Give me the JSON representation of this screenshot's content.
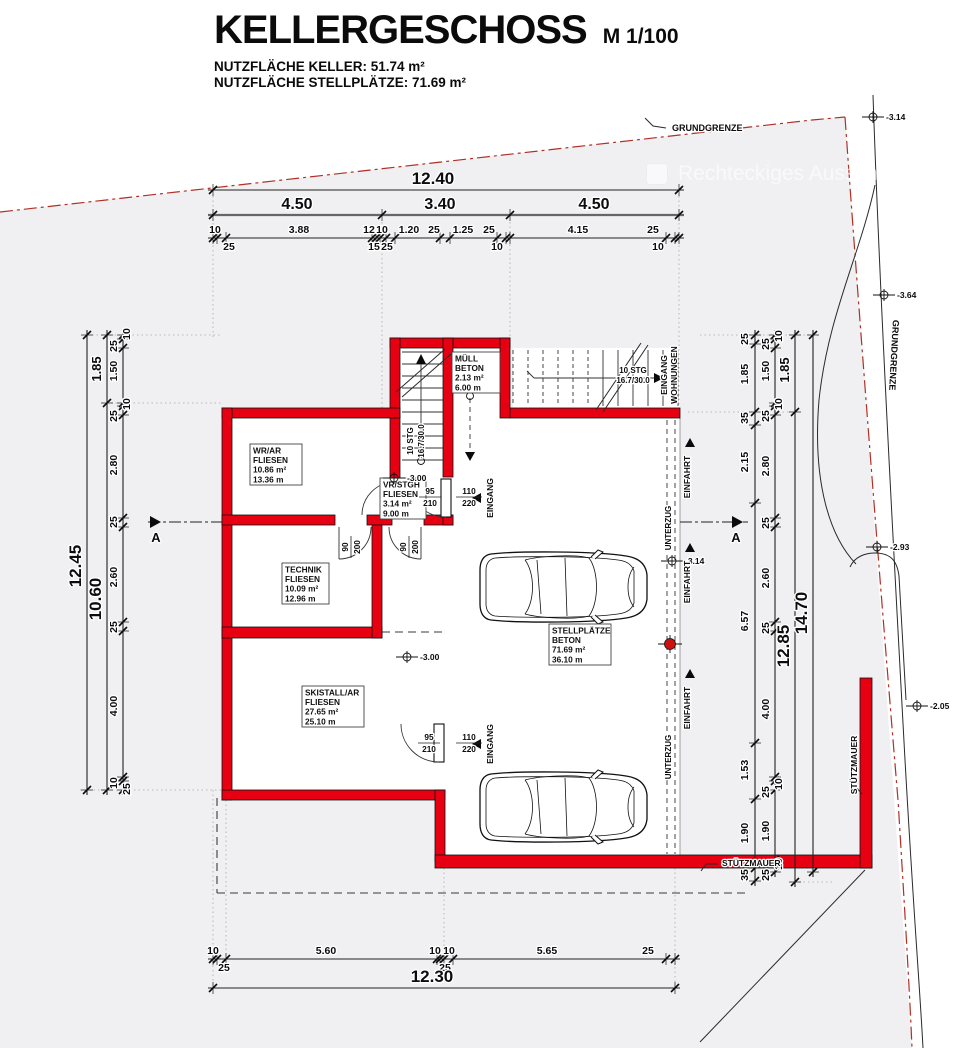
{
  "title": {
    "main": "KELLERGESCHOSS",
    "scale": "M 1/100",
    "sub1": "NUTZFLÄCHE KELLER: 51.74 m²",
    "sub2": "NUTZFLÄCHE STELLPLÄTZE: 71.69 m²"
  },
  "watermark": {
    "text": "Rechteckiges Ausschneiden"
  },
  "colors": {
    "wall": "#e60012",
    "boundary": "#b03026",
    "ground": "#f0f0f2"
  },
  "rooms": [
    {
      "name": "room-wr-ar",
      "x": 250,
      "y": 444,
      "w": 52,
      "h": 41,
      "lines": [
        "WR/AR",
        "FLIESEN",
        "10.86 m²",
        "13.36 m"
      ]
    },
    {
      "name": "room-muell",
      "x": 452,
      "y": 352,
      "w": 48,
      "h": 41,
      "lines": [
        "MÜLL",
        "BETON",
        "2.13 m²",
        "6.00 m"
      ]
    },
    {
      "name": "room-vr-stgh",
      "x": 380,
      "y": 478,
      "w": 46,
      "h": 41,
      "lines": [
        "VR/STGH",
        "FLIESEN",
        "3.14 m²",
        "9.00 m"
      ]
    },
    {
      "name": "room-technik",
      "x": 282,
      "y": 563,
      "w": 47,
      "h": 41,
      "lines": [
        "TECHNIK",
        "FLIESEN",
        "10.09 m²",
        "12.96 m"
      ]
    },
    {
      "name": "room-skistall",
      "x": 302,
      "y": 686,
      "w": 62,
      "h": 41,
      "lines": [
        "SKISTALL/AR",
        "FLIESEN",
        "27.65 m²",
        "25.10 m"
      ]
    },
    {
      "name": "room-stellplaetze",
      "x": 549,
      "y": 624,
      "w": 62,
      "h": 41,
      "lines": [
        "STELLPLÄTZE",
        "BETON",
        "71.69 m²",
        "36.10 m"
      ]
    }
  ],
  "door_labels": [
    {
      "name": "door-size-vr",
      "x": 430,
      "y": 497,
      "top": "95",
      "bottom": "210"
    },
    {
      "name": "door-size-entry-top",
      "x": 469,
      "y": 497,
      "top": "110",
      "bottom": "220"
    },
    {
      "name": "door-size-ski",
      "x": 429,
      "y": 743,
      "top": "95",
      "bottom": "210"
    },
    {
      "name": "door-size-entry-bot",
      "x": 469,
      "y": 743,
      "top": "110",
      "bottom": "220"
    },
    {
      "name": "door-size-technik",
      "x": 351,
      "y": 547,
      "top": "90",
      "bottom": "200",
      "r": -90
    },
    {
      "name": "door-size-corridor",
      "x": 409,
      "y": 547,
      "top": "90",
      "bottom": "200",
      "r": -90
    }
  ],
  "elevations": [
    {
      "x": 394,
      "y": 478,
      "label": "-3.00"
    },
    {
      "x": 407,
      "y": 657,
      "label": "-3.00"
    },
    {
      "x": 672,
      "y": 561,
      "label": "-3.14"
    },
    {
      "x": 873,
      "y": 117,
      "label": "-3.14"
    },
    {
      "x": 884,
      "y": 295,
      "label": "-3.64"
    },
    {
      "x": 877,
      "y": 547,
      "label": "-2.93"
    },
    {
      "x": 917,
      "y": 706,
      "label": "-2.05"
    }
  ],
  "column_marker": {
    "x": 670,
    "y": 644
  },
  "texts": [
    {
      "name": "grundgrenze-top",
      "t": "GRUNDGRENZE",
      "x": 672,
      "y": 131,
      "s": 9,
      "a": "start"
    },
    {
      "name": "grundgrenze-right",
      "t": "GRUNDGRENZE",
      "x": 891,
      "y": 355,
      "s": 9,
      "r": 93
    },
    {
      "name": "eingang-wohnungen-1",
      "t": "EINGANG",
      "x": 667,
      "y": 375,
      "s": 8.5,
      "r": -90
    },
    {
      "name": "eingang-wohnungen-2",
      "t": "WOHNUNGEN",
      "x": 677,
      "y": 375,
      "s": 8.5,
      "r": -90
    },
    {
      "name": "einfahrt-label-1",
      "t": "EINFAHRT",
      "x": 690,
      "y": 477,
      "s": 8.5,
      "r": -90
    },
    {
      "name": "einfahrt-label-2",
      "t": "EINFAHRT",
      "x": 690,
      "y": 582,
      "s": 8.5,
      "r": -90
    },
    {
      "name": "einfahrt-label-3",
      "t": "EINFAHRT",
      "x": 690,
      "y": 708,
      "s": 8.5,
      "r": -90
    },
    {
      "name": "unterzug-label-1",
      "t": "UNTERZUG",
      "x": 671,
      "y": 528,
      "s": 8,
      "r": -90
    },
    {
      "name": "unterzug-label-2",
      "t": "UNTERZUG",
      "x": 671,
      "y": 757,
      "s": 8,
      "r": -90
    },
    {
      "name": "stuetzmauer-bottom",
      "t": "STÜTZMAUER",
      "x": 722,
      "y": 866,
      "s": 8.5,
      "a": "start"
    },
    {
      "name": "stuetzmauer-right",
      "t": "STÜTZMAUER",
      "x": 857,
      "y": 765,
      "s": 8.5,
      "r": -90
    },
    {
      "name": "section-a-left",
      "t": "A",
      "x": 156,
      "y": 542,
      "s": 13,
      "b": 1
    },
    {
      "name": "section-a-right",
      "t": "A",
      "x": 736,
      "y": 542,
      "s": 13,
      "b": 1
    },
    {
      "name": "stair-int-label-1",
      "t": "10 STG",
      "x": 413,
      "y": 441,
      "s": 8,
      "r": -90
    },
    {
      "name": "stair-int-label-2",
      "t": "16.7/30.0",
      "x": 424,
      "y": 441,
      "s": 8,
      "r": -90
    },
    {
      "name": "stair-ext-label-1",
      "t": "10 STG",
      "x": 633,
      "y": 373,
      "s": 8
    },
    {
      "name": "stair-ext-label-2",
      "t": "16.7/30.0",
      "x": 633,
      "y": 383,
      "s": 8
    },
    {
      "name": "eingang-door-1",
      "t": "EINGANG",
      "x": 493,
      "y": 498,
      "s": 8.5,
      "r": -90
    },
    {
      "name": "eingang-door-2",
      "t": "EINGANG",
      "x": 493,
      "y": 744,
      "s": 8.5,
      "r": -90
    }
  ],
  "dims": {
    "h": [
      {
        "name": "top-total",
        "y": 190,
        "ticks": [
          213,
          679
        ],
        "labels": [
          {
            "t": "12.40",
            "x": 433,
            "dy": -6,
            "s": 17,
            "b": 1
          }
        ]
      },
      {
        "name": "top-mid",
        "y": 215,
        "thick": 1,
        "ticks": [
          213,
          382,
          510,
          679
        ],
        "labels": [
          {
            "t": "4.50",
            "x": 297,
            "dy": -6,
            "s": 16,
            "b": 1
          },
          {
            "t": "3.40",
            "x": 440,
            "dy": -6,
            "s": 16,
            "b": 1
          },
          {
            "t": "4.50",
            "x": 594,
            "dy": -6,
            "s": 16,
            "b": 1
          }
        ]
      },
      {
        "name": "top-detail",
        "y": 238,
        "ticks": [
          213,
          217,
          226,
          372,
          376,
          380,
          386,
          395,
          440,
          450,
          497,
          506,
          510,
          666,
          675,
          679
        ],
        "labels": [
          {
            "t": "10",
            "x": 215,
            "dy": -5
          },
          {
            "t": "3.88",
            "x": 299,
            "dy": -5
          },
          {
            "t": "12",
            "x": 369,
            "dy": -5
          },
          {
            "t": "10",
            "x": 382,
            "dy": -5
          },
          {
            "t": "1.20",
            "x": 409,
            "dy": -5
          },
          {
            "t": "25",
            "x": 434,
            "dy": -5
          },
          {
            "t": "1.25",
            "x": 463,
            "dy": -5
          },
          {
            "t": "25",
            "x": 489,
            "dy": -5
          },
          {
            "t": "4.15",
            "x": 578,
            "dy": -5
          },
          {
            "t": "25",
            "x": 653,
            "dy": -5
          },
          {
            "t": "25",
            "x": 229,
            "dy": 12
          },
          {
            "t": "15",
            "x": 374,
            "dy": 12
          },
          {
            "t": "25",
            "x": 387,
            "dy": 12
          },
          {
            "t": "10",
            "x": 497,
            "dy": 12
          },
          {
            "t": "10",
            "x": 658,
            "dy": 12
          }
        ]
      },
      {
        "name": "bottom-detail",
        "y": 959,
        "ticks": [
          213,
          217,
          226,
          437,
          440,
          444,
          453,
          666,
          675
        ],
        "labels": [
          {
            "t": "10",
            "x": 213,
            "dy": -5
          },
          {
            "t": "5.60",
            "x": 326,
            "dy": -5
          },
          {
            "t": "10",
            "x": 435,
            "dy": -5
          },
          {
            "t": "10",
            "x": 449,
            "dy": -5
          },
          {
            "t": "5.65",
            "x": 547,
            "dy": -5
          },
          {
            "t": "25",
            "x": 648,
            "dy": -5
          },
          {
            "t": "25",
            "x": 224,
            "dy": 12
          },
          {
            "t": "25",
            "x": 445,
            "dy": 12
          }
        ]
      },
      {
        "name": "bottom-total",
        "y": 988,
        "ticks": [
          213,
          675
        ],
        "labels": [
          {
            "t": "12.30",
            "x": 432,
            "dy": -6,
            "s": 17,
            "b": 1
          }
        ]
      }
    ],
    "v": [
      {
        "name": "left-total",
        "x": 87,
        "ticks": [
          335,
          790
        ],
        "labels": [
          {
            "t": "12.45",
            "y": 566,
            "dx": -6,
            "s": 17,
            "b": 1
          }
        ]
      },
      {
        "name": "left-mid",
        "x": 107,
        "ticks": [
          335,
          403,
          790
        ],
        "labels": [
          {
            "t": "1.85",
            "y": 369,
            "dx": -6,
            "s": 13,
            "b": 1
          },
          {
            "t": "10.60",
            "y": 599,
            "dx": -6,
            "s": 17,
            "b": 1
          }
        ]
      },
      {
        "name": "left-detail",
        "x": 123,
        "ticks": [
          335,
          339,
          348,
          403,
          406,
          415,
          518,
          527,
          622,
          631,
          777,
          781,
          790
        ],
        "labels": [
          {
            "t": "10",
            "y": 334,
            "dx": 7
          },
          {
            "t": "25",
            "y": 346,
            "dx": -6
          },
          {
            "t": "1.50",
            "y": 371,
            "dx": -6
          },
          {
            "t": "10",
            "y": 404,
            "dx": 7
          },
          {
            "t": "25",
            "y": 416,
            "dx": -6
          },
          {
            "t": "2.80",
            "y": 465,
            "dx": -6
          },
          {
            "t": "25",
            "y": 522,
            "dx": -6
          },
          {
            "t": "2.60",
            "y": 577,
            "dx": -6
          },
          {
            "t": "25",
            "y": 627,
            "dx": -6
          },
          {
            "t": "4.00",
            "y": 706,
            "dx": -6
          },
          {
            "t": "10",
            "y": 783,
            "dx": -6
          },
          {
            "t": "25",
            "y": 789,
            "dx": 7
          }
        ]
      },
      {
        "name": "right-garage",
        "x": 755,
        "ticks": [
          335,
          344,
          412,
          425,
          503,
          743,
          799,
          868,
          881
        ],
        "labels": [
          {
            "t": "25",
            "y": 339,
            "dx": -7
          },
          {
            "t": "1.85",
            "y": 374,
            "dx": -7
          },
          {
            "t": "35",
            "y": 418,
            "dx": -7
          },
          {
            "t": "2.15",
            "y": 462,
            "dx": -7
          },
          {
            "t": "6.57",
            "y": 621,
            "dx": -7
          },
          {
            "t": "1.53",
            "y": 770,
            "dx": -7
          },
          {
            "t": "1.90",
            "y": 833,
            "dx": -7
          },
          {
            "t": "35",
            "y": 875,
            "dx": -7
          }
        ]
      },
      {
        "name": "right-detail",
        "x": 775,
        "ticks": [
          335,
          339,
          348,
          403,
          406,
          415,
          518,
          527,
          622,
          631,
          777,
          781,
          790,
          860,
          863,
          872
        ],
        "labels": [
          {
            "t": "10",
            "y": 336,
            "dx": 7
          },
          {
            "t": "25",
            "y": 344,
            "dx": -6
          },
          {
            "t": "1.50",
            "y": 371,
            "dx": -6
          },
          {
            "t": "10",
            "y": 404,
            "dx": 7
          },
          {
            "t": "25",
            "y": 416,
            "dx": -6
          },
          {
            "t": "2.80",
            "y": 466,
            "dx": -6
          },
          {
            "t": "25",
            "y": 523,
            "dx": -6
          },
          {
            "t": "2.60",
            "y": 578,
            "dx": -6
          },
          {
            "t": "25",
            "y": 628,
            "dx": -6
          },
          {
            "t": "4.00",
            "y": 709,
            "dx": -6
          },
          {
            "t": "10",
            "y": 784,
            "dx": 7
          },
          {
            "t": "25",
            "y": 792,
            "dx": -6
          },
          {
            "t": "1.90",
            "y": 831,
            "dx": -6
          },
          {
            "t": "10",
            "y": 864,
            "dx": 7
          },
          {
            "t": "25",
            "y": 875,
            "dx": -6
          }
        ]
      },
      {
        "name": "right-mid",
        "x": 795,
        "ticks": [
          335,
          412,
          882
        ],
        "labels": [
          {
            "t": "1.85",
            "y": 370,
            "dx": -6,
            "s": 13,
            "b": 1
          },
          {
            "t": "12.85",
            "y": 646,
            "dx": -6,
            "s": 17,
            "b": 1
          }
        ]
      },
      {
        "name": "right-total",
        "x": 813,
        "ticks": [
          335,
          872
        ],
        "labels": [
          {
            "t": "14.70",
            "y": 613,
            "dx": -6,
            "s": 17,
            "b": 1
          }
        ]
      }
    ]
  }
}
